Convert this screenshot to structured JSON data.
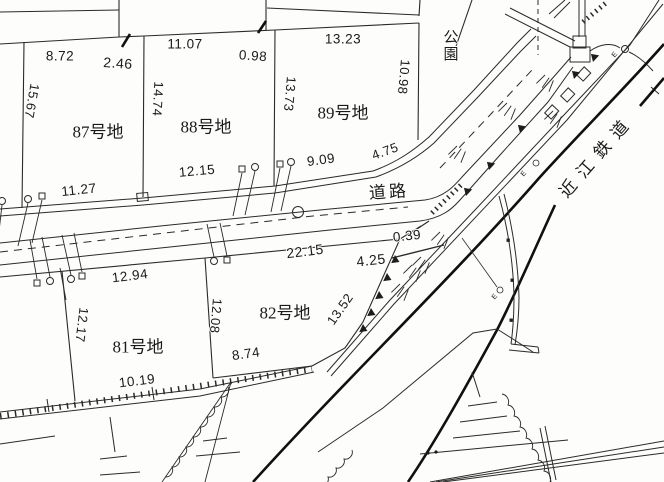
{
  "palette": {
    "line": "#2a2a2a",
    "railway": "#101010",
    "background": "#fdfdfb",
    "text": "#1a1a1a"
  },
  "labels": {
    "lot87": "87号地",
    "lot88": "88号地",
    "lot89": "89号地",
    "lot81": "81号地",
    "lot82": "82号地",
    "park": "公園",
    "road": "道路",
    "railway": "近江鉄道",
    "e_marker": "E"
  },
  "measurements": {
    "m_8_72": "8.72",
    "m_2_46": "2.46",
    "m_11_07": "11.07",
    "m_0_98": "0.98",
    "m_13_23": "13.23",
    "m_10_98": "10.98",
    "m_15_67": "15.67",
    "m_14_74": "14.74",
    "m_13_73": "13.73",
    "m_4_75": "4.75",
    "m_9_09": "9.09",
    "m_12_15": "12.15",
    "m_11_27": "11.27",
    "m_0_39": "0.39",
    "m_22_15": "22.15",
    "m_4_25": "4.25",
    "m_12_94": "12.94",
    "m_12_17": "12.17",
    "m_12_08": "12.08",
    "m_13_52": "13.52",
    "m_8_74": "8.74",
    "m_10_19": "10.19"
  }
}
